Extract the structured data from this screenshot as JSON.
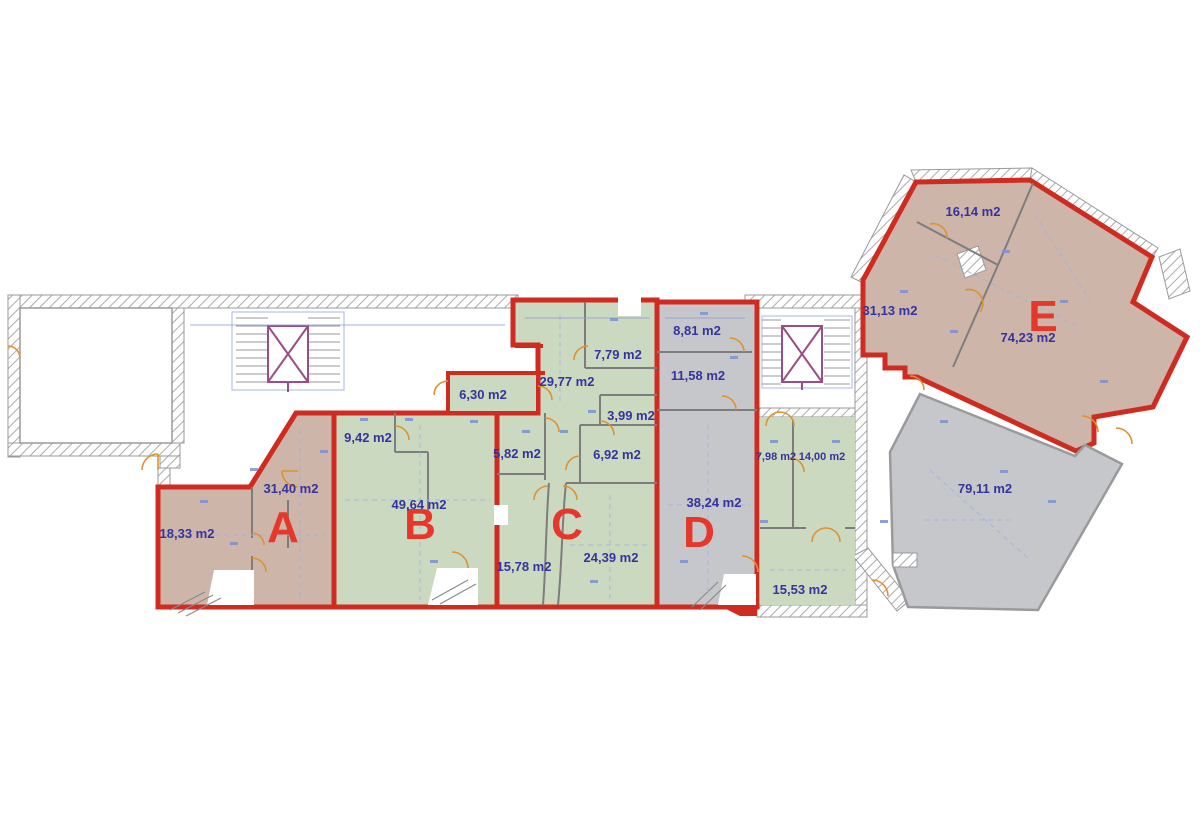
{
  "units": {
    "a": {
      "letter": "A",
      "areas": [
        "31,40 m2",
        "18,33 m2"
      ]
    },
    "b": {
      "letter": "B",
      "areas": [
        "9,42 m2",
        "49,64 m2"
      ]
    },
    "c": {
      "letter": "C",
      "areas": [
        "6,30 m2",
        "29,77 m2",
        "7,79 m2",
        "3,99 m2",
        "5,82 m2",
        "6,92 m2",
        "15,78 m2",
        "24,39 m2"
      ]
    },
    "d": {
      "letter": "D",
      "areas": [
        "8,81 m2",
        "11,58 m2",
        "38,24 m2"
      ]
    },
    "e": {
      "letter": "E",
      "areas": [
        "16,14 m2",
        "31,13 m2",
        "74,23 m2"
      ]
    }
  },
  "other_rooms": {
    "areas": [
      "7,98 m2",
      "14,00 m2",
      "15,53 m2",
      "79,11 m2"
    ]
  },
  "colors": {
    "unit_outline_red": "#cf2b20",
    "unit_letter_red": "#e5372a",
    "area_text_blue": "#34349c",
    "tan_fill": "#cdb5a9",
    "green_fill": "#ccd9c1",
    "gray_fill": "#c6c7cb",
    "door_orange": "#e0912f",
    "dimension_blue": "#8b9bd9",
    "elevator_purple": "#9b4d86",
    "wall_hatch_gray": "#9a9a9a"
  }
}
